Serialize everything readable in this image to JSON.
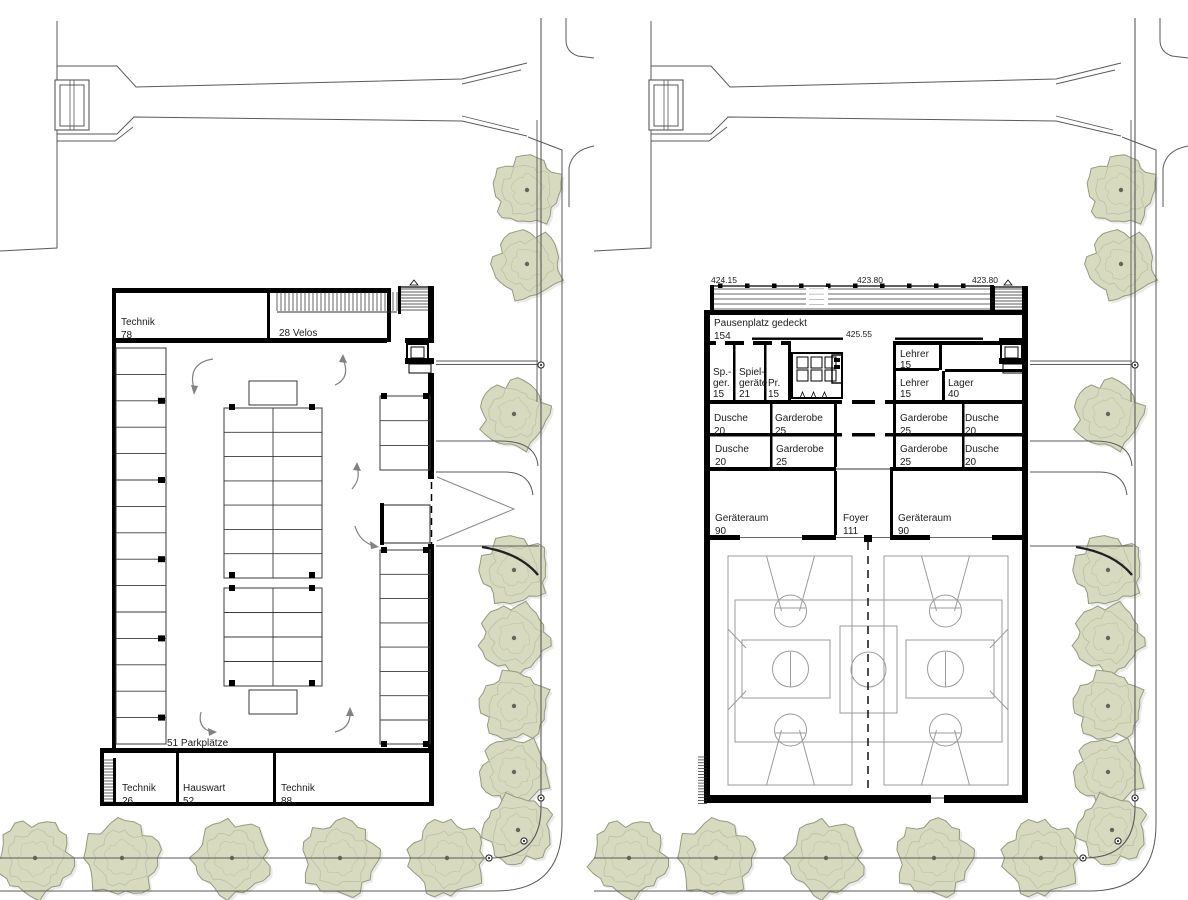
{
  "colors": {
    "wall": "#000000",
    "line": "#3c3c3c",
    "road": "#5a5a5a",
    "court": "#9b9b9b",
    "tree_fill": "#d7dabf",
    "tree_stroke": "#939b80",
    "tree_texture": "#b9bfa0",
    "tree_dot": "#63665a",
    "arrow": "#828282",
    "text": "#1c1c1c"
  },
  "panels": [
    {
      "id": "parking-level-plan",
      "rooms": [
        {
          "id": "technik-78",
          "name": "Technik",
          "area": "78",
          "x": 121,
          "y": 325
        },
        {
          "id": "technik-26",
          "name": "Technik",
          "area": "26",
          "x": 122,
          "y": 791
        },
        {
          "id": "hauswart-52",
          "name": "Hauswart",
          "area": "52",
          "x": 183,
          "y": 791
        },
        {
          "id": "technik-88",
          "name": "Technik",
          "area": "88",
          "x": 281,
          "y": 791
        }
      ],
      "annotations": [
        {
          "id": "velos",
          "text": "28 Velos",
          "x": 279,
          "y": 336
        },
        {
          "id": "parkplaetze",
          "text": "51 Parkplätze",
          "x": 167,
          "y": 746
        }
      ],
      "elevations": []
    },
    {
      "id": "sports-hall-ground-floor-plan",
      "rooms": [
        {
          "id": "pausenplatz",
          "name": "Pausenplatz gedeckt",
          "area": "154",
          "x": 120,
          "y": 326
        },
        {
          "id": "sp-ger",
          "lines": [
            "Sp.-",
            "ger.",
            "15"
          ],
          "x": 119,
          "y": 375
        },
        {
          "id": "spielgeraete",
          "lines": [
            "Spiel-",
            "geräte",
            "21"
          ],
          "x": 145,
          "y": 375
        },
        {
          "id": "pr",
          "lines": [
            "Pr.",
            "15"
          ],
          "x": 174,
          "y": 386
        },
        {
          "id": "dusche-l1",
          "name": "Dusche",
          "area": "20",
          "x": 120,
          "y": 421
        },
        {
          "id": "garderobe-l1",
          "name": "Garderobe",
          "area": "25",
          "x": 181,
          "y": 421
        },
        {
          "id": "dusche-l2",
          "name": "Dusche",
          "area": "20",
          "x": 121,
          "y": 452
        },
        {
          "id": "garderobe-l2",
          "name": "Garderobe",
          "area": "25",
          "x": 182,
          "y": 452
        },
        {
          "id": "lehrer-1",
          "name": "Lehrer",
          "area": "15",
          "dy": 11,
          "x": 306,
          "y": 357
        },
        {
          "id": "lehrer-2",
          "name": "Lehrer",
          "area": "15",
          "dy": 11,
          "x": 306,
          "y": 386
        },
        {
          "id": "lager",
          "name": "Lager",
          "area": "40",
          "dy": 11,
          "x": 354,
          "y": 386
        },
        {
          "id": "garderobe-r1",
          "name": "Garderobe",
          "area": "25",
          "x": 306,
          "y": 421
        },
        {
          "id": "dusche-r1",
          "name": "Dusche",
          "area": "20",
          "x": 371,
          "y": 421
        },
        {
          "id": "garderobe-r2",
          "name": "Garderobe",
          "area": "25",
          "x": 306,
          "y": 452
        },
        {
          "id": "dusche-r2",
          "name": "Dusche",
          "area": "20",
          "x": 371,
          "y": 452
        },
        {
          "id": "geraeteraum-1",
          "name": "Geräteraum",
          "area": "90",
          "x": 121,
          "y": 521
        },
        {
          "id": "foyer",
          "name": "Foyer",
          "area": "111",
          "x": 249,
          "y": 521
        },
        {
          "id": "geraeteraum-2",
          "name": "Geräteraum",
          "area": "90",
          "x": 304,
          "y": 521
        }
      ],
      "annotations": [],
      "elevations": [
        {
          "text": "424.15",
          "x": 117,
          "y": 283
        },
        {
          "text": "423.80",
          "x": 263,
          "y": 283
        },
        {
          "text": "423.80",
          "x": 378,
          "y": 283
        },
        {
          "text": "425.55",
          "x": 252,
          "y": 337
        }
      ]
    }
  ],
  "site": {
    "side_trees": [
      [
        527,
        190
      ],
      [
        527,
        264
      ],
      [
        514,
        414
      ],
      [
        514,
        570
      ],
      [
        514,
        638
      ],
      [
        514,
        706
      ],
      [
        514,
        772
      ]
    ],
    "corner_tree": [
      518,
      830
    ],
    "bottom_trees": [
      [
        35,
        858
      ],
      [
        122,
        858
      ],
      [
        232,
        858
      ],
      [
        340,
        858
      ],
      [
        447,
        858
      ]
    ],
    "tree_radius": 38
  }
}
